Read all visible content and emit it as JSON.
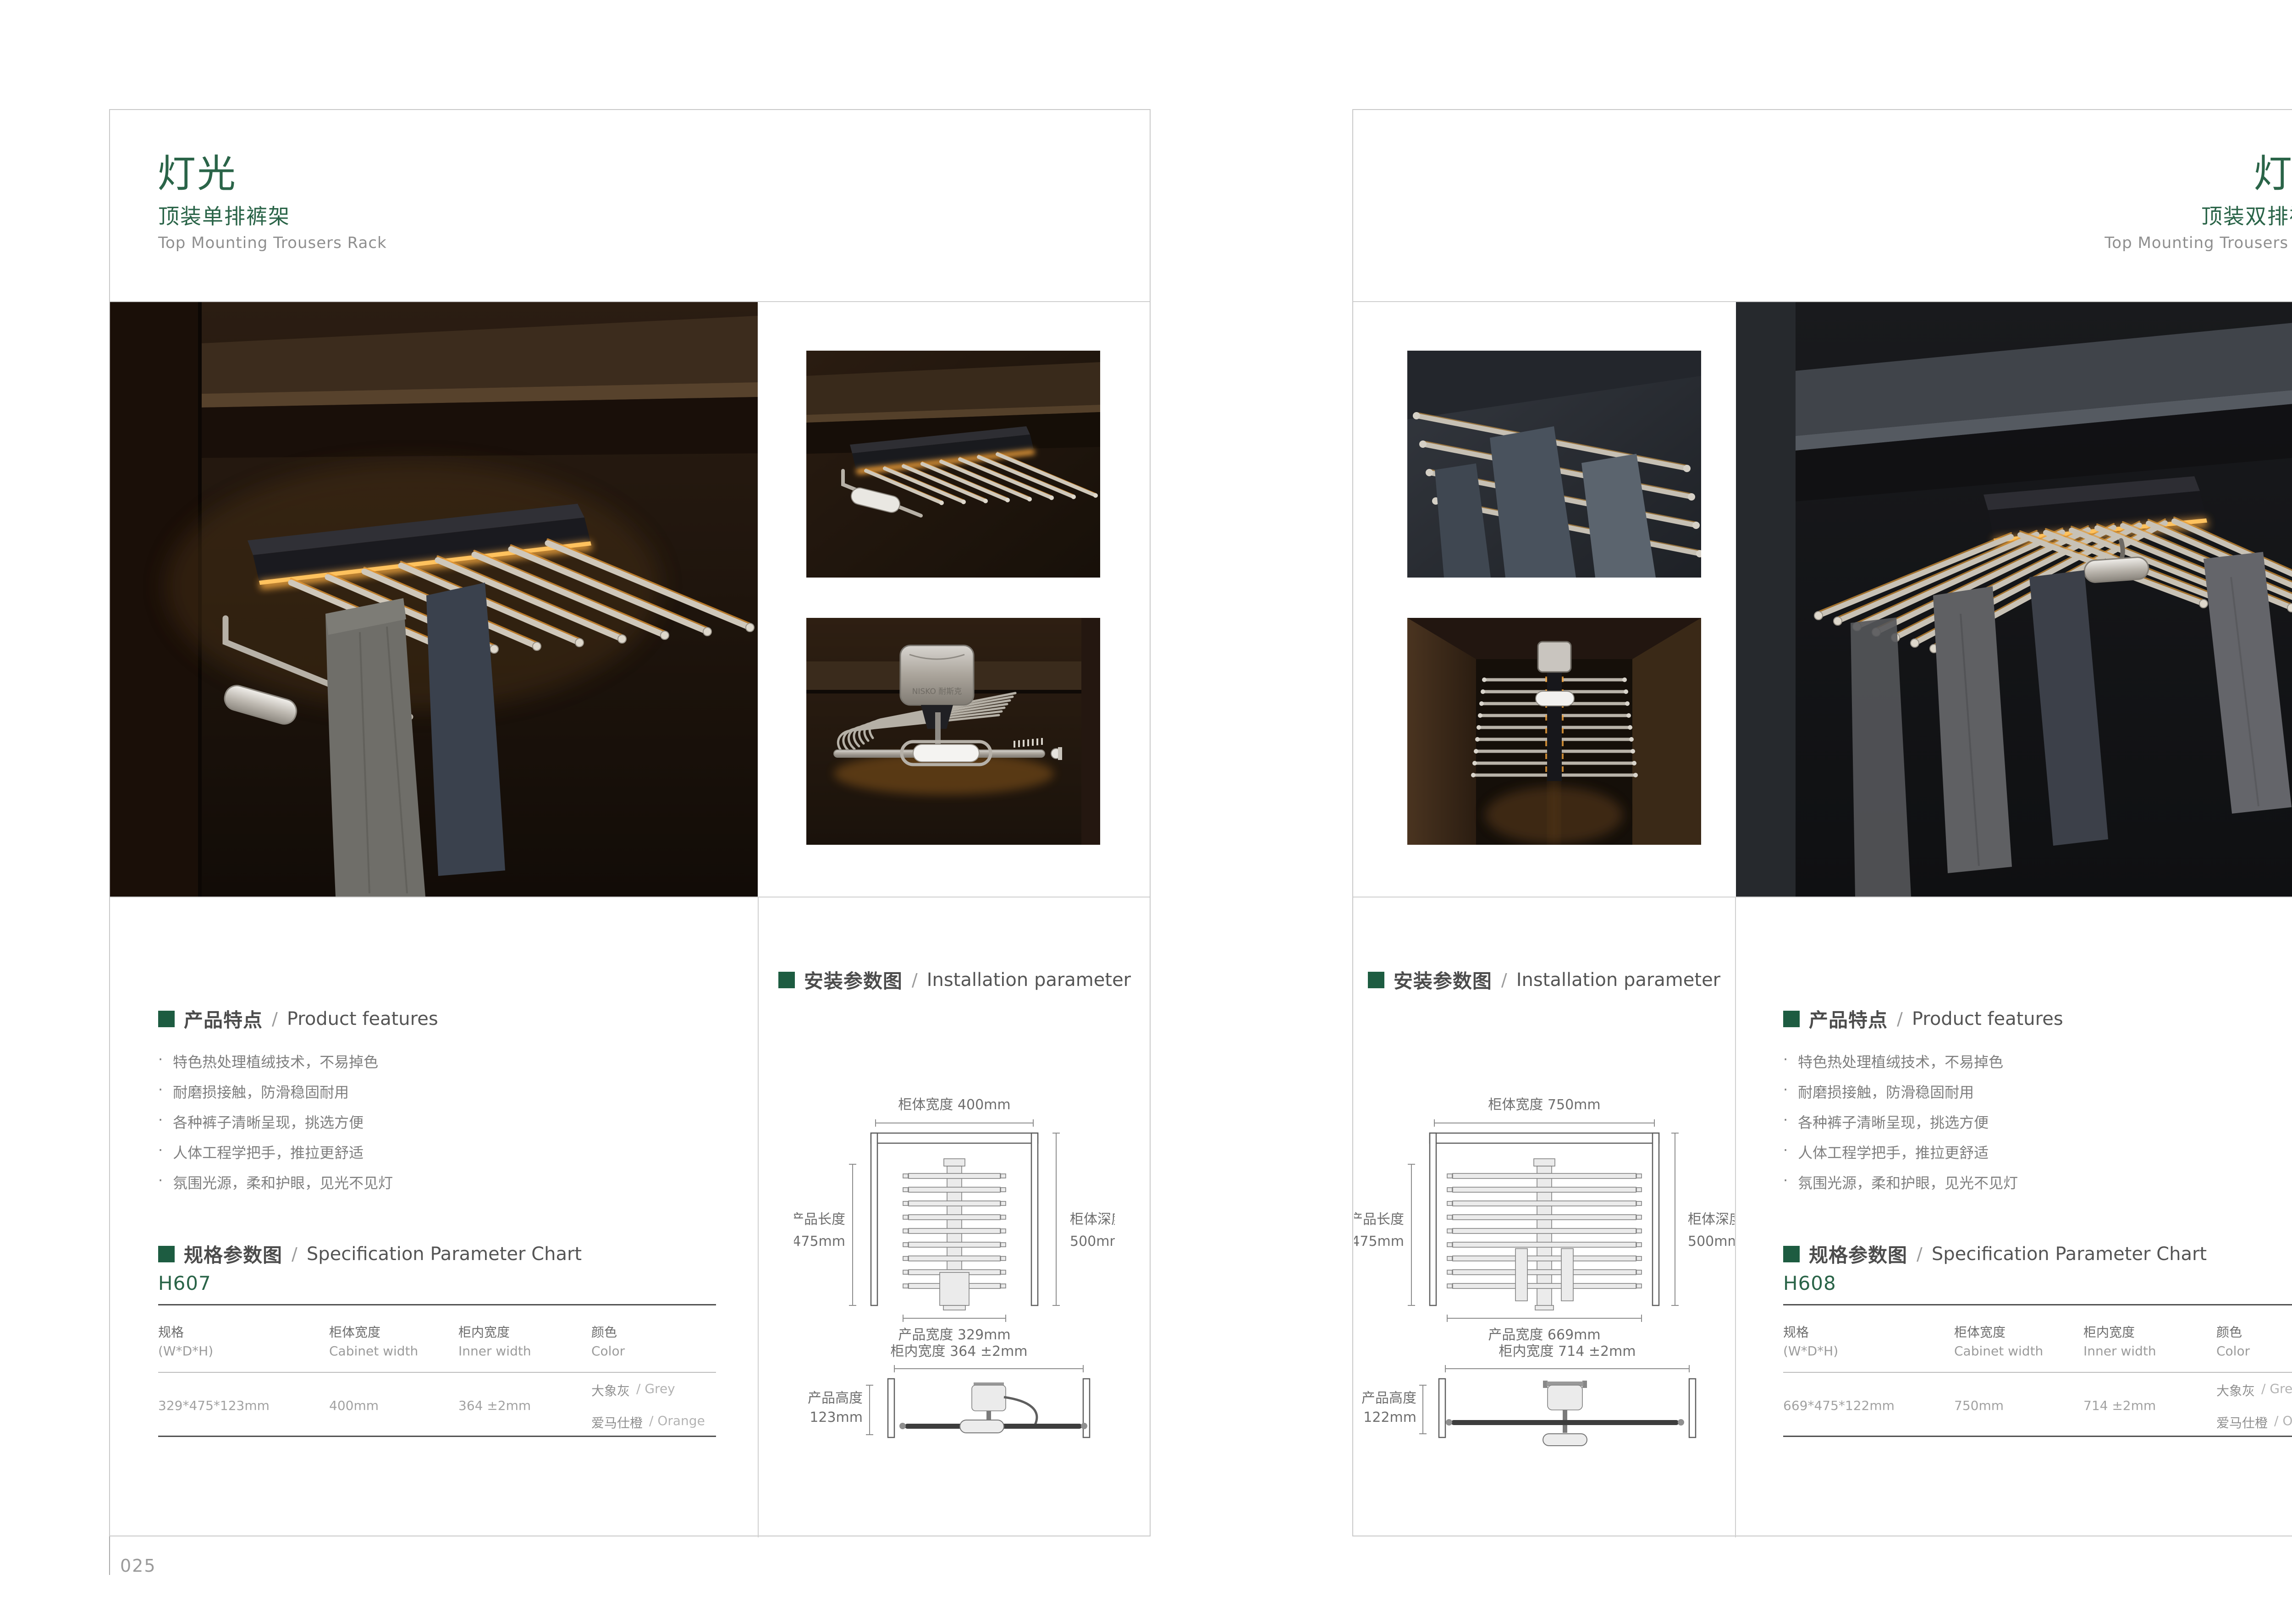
{
  "ui": {
    "bullet": "·",
    "sep": "/",
    "logo": "NISKO 耐斯克"
  },
  "accent_green": "#2a6448",
  "left_page": {
    "page_number": "025",
    "header": {
      "title": "灯光",
      "subtitle": "顶装单排裤架",
      "subtitle_en": "Top Mounting Trousers Rack"
    },
    "features": {
      "heading_cn": "产品特点",
      "heading_en": "Product features",
      "items": [
        "特色热处理植绒技术，不易掉色",
        "耐磨损接触，防滑稳固耐用",
        "各种裤子清晰呈现，挑选方便",
        "人体工程学把手，推拉更舒适",
        "氛围光源，柔和护眼，见光不见灯"
      ]
    },
    "spec": {
      "heading_cn": "规格参数图",
      "heading_en": "Specification Parameter Chart",
      "model": "H607",
      "col1_cn": "规格",
      "col1_en": "(W*D*H)",
      "col2_cn": "柜体宽度",
      "col2_en": "Cabinet width",
      "col3_cn": "柜内宽度",
      "col3_en": "Inner width",
      "col4_cn": "颜色",
      "col4_en": "Color",
      "val_size": "329*475*123mm",
      "val_cabinet": "400mm",
      "val_inner": "364 ±2mm",
      "color1_cn": "大象灰",
      "color1_en": "/ Grey",
      "color2_cn": "爱马仕橙",
      "color2_en": "/ Orange"
    },
    "installation": {
      "heading_cn": "安装参数图",
      "heading_en": "Installation parameter",
      "top": {
        "width_label": "柜体宽度 400mm",
        "length_cn": "产品长度",
        "length_val": "475mm",
        "depth_cn": "柜体深度",
        "depth_val": "500mm",
        "pwidth_label": "产品宽度 329mm"
      },
      "front": {
        "inner_label": "柜内宽度 364 ±2mm",
        "height_cn": "产品高度",
        "height_val": "123mm"
      }
    }
  },
  "right_page": {
    "page_number": "026",
    "header": {
      "title": "灯光",
      "subtitle": "顶装双排裤架",
      "subtitle_en": "Top Mounting Trousers Rack"
    },
    "features": {
      "heading_cn": "产品特点",
      "heading_en": "Product features",
      "items": [
        "特色热处理植绒技术，不易掉色",
        "耐磨损接触，防滑稳固耐用",
        "各种裤子清晰呈现，挑选方便",
        "人体工程学把手，推拉更舒适",
        "氛围光源，柔和护眼，见光不见灯"
      ]
    },
    "spec": {
      "heading_cn": "规格参数图",
      "heading_en": "Specification Parameter Chart",
      "model": "H608",
      "col1_cn": "规格",
      "col1_en": "(W*D*H)",
      "col2_cn": "柜体宽度",
      "col2_en": "Cabinet width",
      "col3_cn": "柜内宽度",
      "col3_en": "Inner width",
      "col4_cn": "颜色",
      "col4_en": "Color",
      "val_size": "669*475*122mm",
      "val_cabinet": "750mm",
      "val_inner": "714 ±2mm",
      "color1_cn": "大象灰",
      "color1_en": "/ Grey",
      "color2_cn": "爱马仕橙",
      "color2_en": "/ Orange"
    },
    "installation": {
      "heading_cn": "安装参数图",
      "heading_en": "Installation parameter",
      "top": {
        "width_label": "柜体宽度 750mm",
        "length_cn": "产品长度",
        "length_val": "475mm",
        "depth_cn": "柜体深度",
        "depth_val": "500mm",
        "pwidth_label": "产品宽度 669mm"
      },
      "front": {
        "inner_label": "柜内宽度 714 ±2mm",
        "height_cn": "产品高度",
        "height_val": "122mm"
      }
    }
  }
}
